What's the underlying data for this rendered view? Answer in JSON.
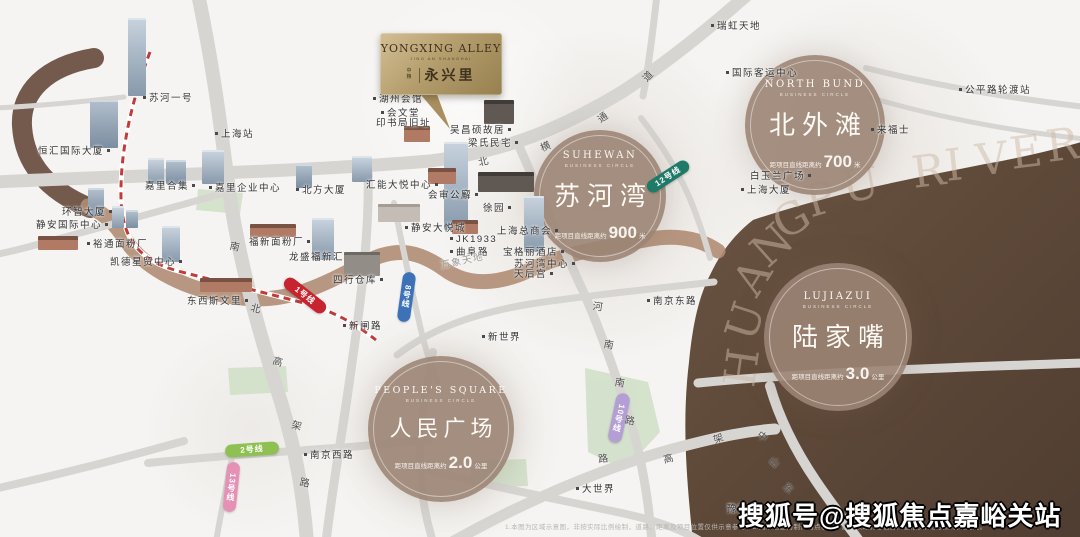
{
  "meta": {
    "watermark": "搜狐号@搜狐焦点嘉峪关站",
    "disclaimer": "1.本图为区域示意图，非按实际比例绘制，道路、距离及项目位置仅供示意参考；2.图示信息为制作时点状况，最终以政府主管部门批准文件及实际状况为准。"
  },
  "badge": {
    "en": "YONGXING ALLEY",
    "sub": "JING AN SHANGHAI",
    "brand": "中粮",
    "zh": "永兴里"
  },
  "huangpu": {
    "name": "HUANGPU RIVER"
  },
  "colors": {
    "river": "#5d4838",
    "creek": "#b08d74",
    "road": "#d7d5d2",
    "park": "#cfdec6",
    "circle_bg": "#9b8474",
    "badge_gold": "#b59e6d",
    "railway": "#c23b3b"
  },
  "circles": [
    {
      "id": "circle-suhewan",
      "en": "SUHEWAN",
      "sub": "BUSINESS CIRCLE",
      "zh": "苏河湾",
      "dist_prefix": "距项目直线距离约",
      "dist_value": "900",
      "dist_unit": "米",
      "x": 600,
      "y": 196,
      "r": 66
    },
    {
      "id": "circle-north-bund",
      "en": "NORTH BUND",
      "sub": "BUSINESS CIRCLE",
      "zh": "北外滩",
      "dist_prefix": "距项目直线距离约",
      "dist_value": "700",
      "dist_unit": "米",
      "x": 815,
      "y": 125,
      "r": 70
    },
    {
      "id": "circle-lujiazui",
      "en": "LUJIAZUI",
      "sub": "BUSINESS CIRCLE",
      "zh": "陆家嘴",
      "dist_prefix": "距项目直线距离约",
      "dist_value": "3.0",
      "dist_unit": "公里",
      "x": 838,
      "y": 337,
      "r": 74
    },
    {
      "id": "circle-peoples-square",
      "en": "PEOPLE'S SQUARE",
      "sub": "BUSINESS CIRCLE",
      "zh": "人民广场",
      "dist_prefix": "距项目直线距离约",
      "dist_value": "2.0",
      "dist_unit": "公里",
      "x": 441,
      "y": 429,
      "r": 73
    }
  ],
  "pois": [
    {
      "t": "苏河一号",
      "x": 140,
      "y": 95,
      "d": "l"
    },
    {
      "t": "恒汇国际大厦",
      "x": 38,
      "y": 148,
      "d": "r"
    },
    {
      "t": "上海站",
      "x": 212,
      "y": 131,
      "d": "l"
    },
    {
      "t": "嘉里合集",
      "x": 145,
      "y": 183,
      "d": "r"
    },
    {
      "t": "嘉里企业中心",
      "x": 206,
      "y": 185,
      "d": "l"
    },
    {
      "t": "环智大厦",
      "x": 62,
      "y": 209,
      "d": "r"
    },
    {
      "t": "静安国际中心",
      "x": 36,
      "y": 222,
      "d": "r"
    },
    {
      "t": "裕通面粉厂",
      "x": 84,
      "y": 241,
      "d": "l"
    },
    {
      "t": "凯德星贸中心",
      "x": 110,
      "y": 259,
      "d": "r"
    },
    {
      "t": "东西斯文里",
      "x": 187,
      "y": 298,
      "d": "r"
    },
    {
      "t": "福新面粉厂",
      "x": 249,
      "y": 239,
      "d": "r"
    },
    {
      "t": "龙盛福新汇",
      "x": 289,
      "y": 254,
      "d": "n"
    },
    {
      "t": "四行仓库",
      "x": 333,
      "y": 277,
      "d": "r"
    },
    {
      "t": "新闸路",
      "x": 340,
      "y": 323,
      "d": "l"
    },
    {
      "t": "新世界",
      "x": 479,
      "y": 334,
      "d": "l"
    },
    {
      "t": "静安大悦城",
      "x": 402,
      "y": 225,
      "d": "l"
    },
    {
      "t": "汇能大悦中心",
      "x": 366,
      "y": 182,
      "d": "r"
    },
    {
      "t": "北方大厦",
      "x": 293,
      "y": 187,
      "d": "l"
    },
    {
      "t": "会审公廨",
      "x": 428,
      "y": 192,
      "d": "r"
    },
    {
      "t": "徐园",
      "x": 483,
      "y": 205,
      "d": "r"
    },
    {
      "t": "上海总商会",
      "x": 497,
      "y": 228,
      "d": "r"
    },
    {
      "t": "JK1933",
      "x": 447,
      "y": 239,
      "d": "l"
    },
    {
      "t": "曲阜路",
      "x": 447,
      "y": 249,
      "d": "l"
    },
    {
      "t": "万象天地",
      "x": 440,
      "y": 258,
      "d": "n",
      "c": "#9a9792",
      "rot": -12
    },
    {
      "t": "宝格丽酒店",
      "x": 503,
      "y": 249,
      "d": "r"
    },
    {
      "t": "苏河湾中心",
      "x": 514,
      "y": 261,
      "d": "r"
    },
    {
      "t": "天后宫",
      "x": 514,
      "y": 271,
      "d": "r"
    },
    {
      "t": "湖州会馆",
      "x": 370,
      "y": 96,
      "d": "l"
    },
    {
      "t": "会文堂",
      "x": 378,
      "y": 110,
      "d": "l"
    },
    {
      "t": "印书局旧址",
      "x": 376,
      "y": 120,
      "d": "n"
    },
    {
      "t": "吴昌硕故居",
      "x": 450,
      "y": 127,
      "d": "r"
    },
    {
      "t": "梁氏民宅",
      "x": 468,
      "y": 140,
      "d": "r"
    },
    {
      "t": "南京东路",
      "x": 644,
      "y": 298,
      "d": "l"
    },
    {
      "t": "白玉兰广场",
      "x": 750,
      "y": 173,
      "d": "r"
    },
    {
      "t": "上海大厦",
      "x": 738,
      "y": 187,
      "d": "l"
    },
    {
      "t": "瑞虹天地",
      "x": 708,
      "y": 23,
      "d": "l"
    },
    {
      "t": "国际客运中心",
      "x": 723,
      "y": 70,
      "d": "l"
    },
    {
      "t": "公平路轮渡站",
      "x": 956,
      "y": 87,
      "d": "l"
    },
    {
      "t": "来福士",
      "x": 868,
      "y": 127,
      "d": "l"
    },
    {
      "t": "大世界",
      "x": 573,
      "y": 486,
      "d": "l"
    },
    {
      "t": "豫园",
      "x": 718,
      "y": 506,
      "d": "l"
    },
    {
      "t": "南京西路",
      "x": 301,
      "y": 452,
      "d": "l"
    }
  ],
  "road_labels": [
    {
      "name": "南北高架路",
      "chars": [
        [
          "南",
          230,
          238,
          12
        ],
        [
          "北",
          251,
          300,
          14
        ],
        [
          "高",
          273,
          353,
          16
        ],
        [
          "架",
          292,
          417,
          14
        ],
        [
          "路",
          300,
          474,
          10
        ]
      ]
    },
    {
      "name": "北横通道",
      "chars": [
        [
          "北",
          478,
          153,
          -14
        ],
        [
          "横",
          540,
          138,
          -22
        ],
        [
          "通",
          597,
          109,
          -34
        ],
        [
          "道",
          642,
          68,
          -46
        ]
      ]
    },
    {
      "name": "河南南路",
      "chars": [
        [
          "河",
          593,
          298,
          8
        ],
        [
          "南",
          604,
          336,
          10
        ],
        [
          "南",
          615,
          374,
          10
        ],
        [
          "路",
          625,
          412,
          9
        ]
      ]
    },
    {
      "name": "延安高架路",
      "chars": [
        [
          "路",
          598,
          450,
          -6
        ],
        [
          "高",
          663,
          450,
          -14
        ],
        [
          "架",
          713,
          430,
          -22
        ]
      ]
    },
    {
      "name": "中山东路",
      "chars": [
        [
          "中",
          758,
          428,
          38
        ],
        [
          "山",
          770,
          454,
          42
        ],
        [
          "东",
          784,
          480,
          45
        ],
        [
          "路",
          799,
          505,
          48
        ]
      ]
    }
  ],
  "metro": [
    {
      "label": "1号线",
      "color": "#c8242f",
      "x": 280,
      "y": 289,
      "w": 50,
      "h": 13,
      "rot": 38,
      "vertical": false
    },
    {
      "label": "8号线",
      "color": "#3d72b8",
      "x": 400,
      "y": 272,
      "w": 13,
      "h": 50,
      "rot": 8,
      "vertical": true
    },
    {
      "label": "12号线",
      "color": "#1f7a68",
      "x": 644,
      "y": 170,
      "w": 48,
      "h": 13,
      "rot": -33,
      "vertical": false
    },
    {
      "label": "10号线",
      "color": "#b39fd4",
      "x": 612,
      "y": 393,
      "w": 14,
      "h": 50,
      "rot": 12,
      "vertical": true
    },
    {
      "label": "2号线",
      "color": "#8fc152",
      "x": 225,
      "y": 443,
      "w": 54,
      "h": 13,
      "rot": -4,
      "vertical": false
    },
    {
      "label": "13号线",
      "color": "#e591b6",
      "x": 225,
      "y": 462,
      "w": 13,
      "h": 50,
      "rot": 6,
      "vertical": true
    }
  ]
}
